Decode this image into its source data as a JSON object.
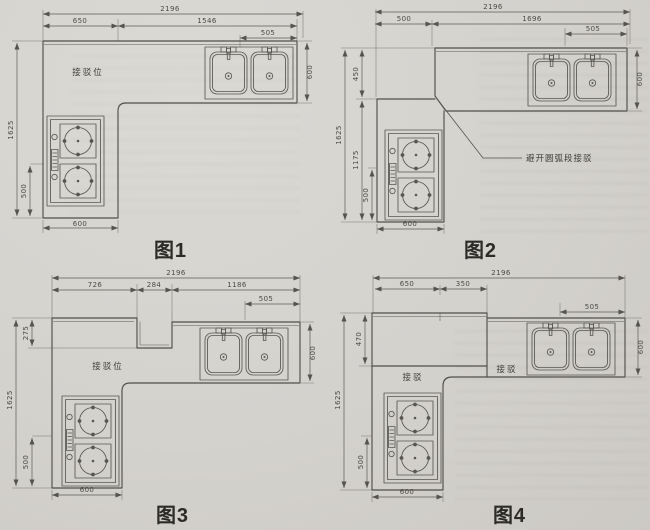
{
  "page": {
    "background_color": "#d4d2cd",
    "ink_color": "#504f4b",
    "caption_color": "#2c2b28"
  },
  "figures": [
    {
      "caption": "图1",
      "label_connection": "接驳位",
      "dims": {
        "total_width": "2196",
        "top_left": "650",
        "top_right": "1546",
        "sink_width": "505",
        "counter_depth": "600",
        "total_height": "1625",
        "stove_bottom": "500",
        "leg_width": "600"
      }
    },
    {
      "caption": "图2",
      "label_connection": "避开圆弧段接驳",
      "dims": {
        "total_width": "2196",
        "top_left": "500",
        "top_right": "1696",
        "sink_width": "505",
        "counter_depth": "600",
        "offset_top": "450",
        "total_height": "1625",
        "leg_height": "1175",
        "stove_bottom": "500",
        "leg_width": "600"
      }
    },
    {
      "caption": "图3",
      "label_connection": "接驳位",
      "dims": {
        "total_width": "2196",
        "top_left": "726",
        "top_mid": "284",
        "top_right": "1186",
        "sink_width": "505",
        "counter_depth": "600",
        "notch_depth": "275",
        "total_height": "1625",
        "stove_bottom": "500",
        "leg_width": "600"
      }
    },
    {
      "caption": "图4",
      "label_connection": "接驳",
      "label_connection2": "接驳",
      "dims": {
        "total_width": "2196",
        "top_left": "650",
        "top_mid": "350",
        "sink_width": "505",
        "counter_depth": "600",
        "offset_top": "470",
        "total_height": "1625",
        "stove_bottom": "500",
        "leg_width": "600"
      }
    }
  ]
}
